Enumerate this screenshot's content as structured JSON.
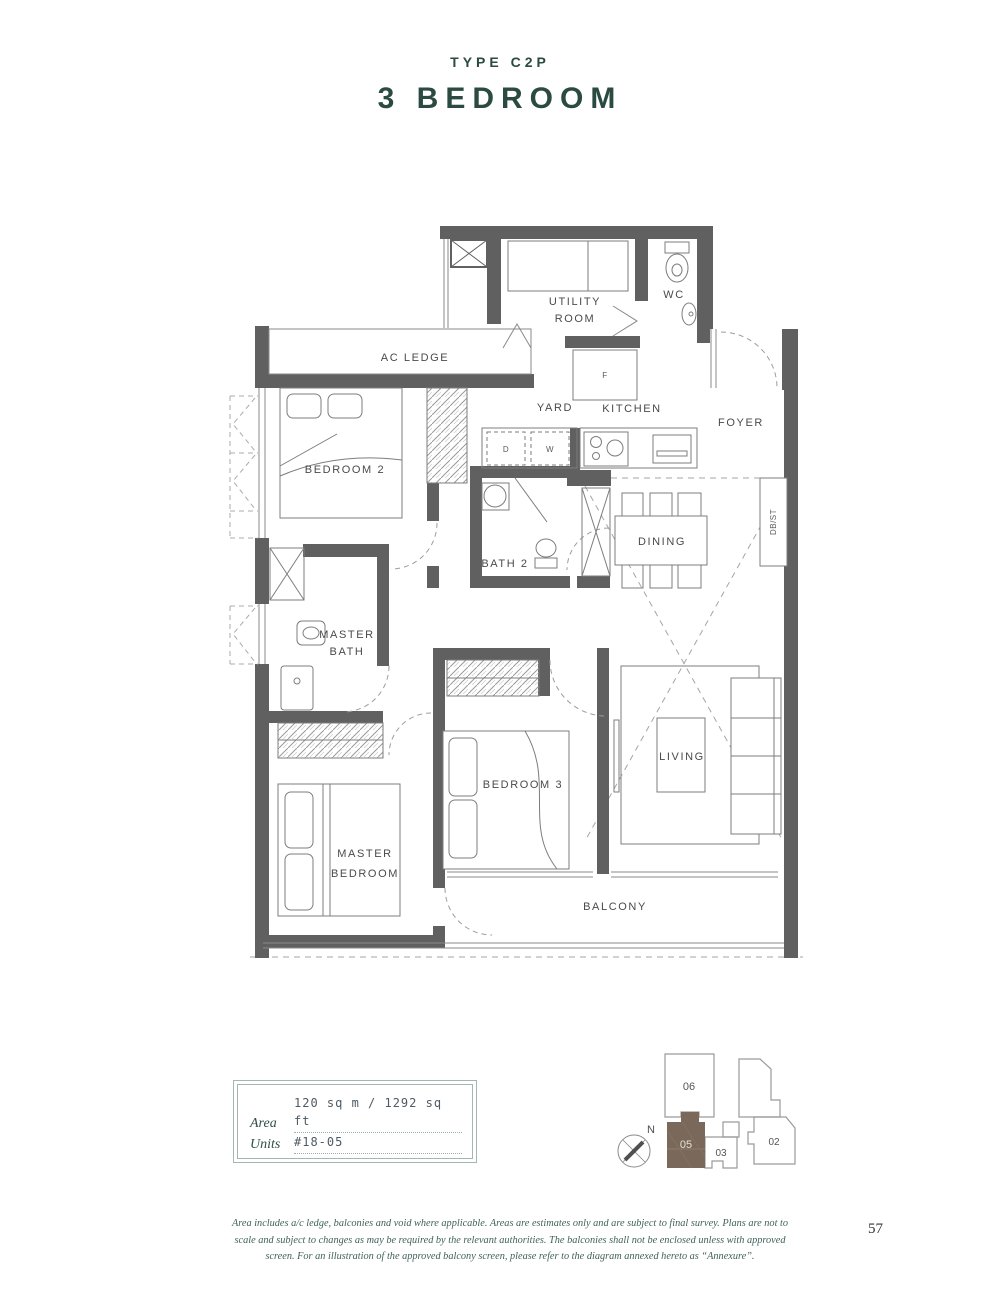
{
  "header": {
    "type_label": "TYPE C2P",
    "title": "3 BEDROOM"
  },
  "floor_plan": {
    "rooms": {
      "ac_ledge": "AC LEDGE",
      "utility_line1": "UTILITY",
      "utility_line2": "ROOM",
      "wc": "WC",
      "yard": "YARD",
      "kitchen": "KITCHEN",
      "foyer": "FOYER",
      "bedroom2": "BEDROOM 2",
      "bath2": "BATH 2",
      "dining": "DINING",
      "master_bath_line1": "MASTER",
      "master_bath_line2": "BATH",
      "bedroom3": "BEDROOM 3",
      "living": "LIVING",
      "master_bedroom_line1": "MASTER",
      "master_bedroom_line2": "BEDROOM",
      "balcony": "BALCONY"
    },
    "appliances": {
      "dryer": "D",
      "washer": "W",
      "fridge": "F",
      "db_st": "DB/ST"
    }
  },
  "info_box": {
    "area_label": "Area",
    "area_value": "120 sq m / 1292 sq ft",
    "units_label": "Units",
    "units_value": "#18-05"
  },
  "key_plan": {
    "compass": "N",
    "unit_06": "06",
    "unit_05": "05",
    "unit_03": "03",
    "unit_02": "02",
    "highlighted_unit": "05"
  },
  "footer": {
    "line1": "Area includes a/c ledge, balconies and void where applicable. Areas are estimates only and are subject to final survey. Plans are not to",
    "line2": "scale and subject to changes as may be required by the relevant authorities. The balconies shall not be enclosed unless with approved",
    "line3": "screen. For an illustration of the approved balcony screen, please refer to the diagram annexed hereto as “Annexure”."
  },
  "page_number": "57",
  "colors": {
    "title": "#2b4a41",
    "wall": "#606060",
    "keyplan_highlight": "#7a695a",
    "footer_text": "#3f615a",
    "info_border": "#a3b6b0"
  }
}
